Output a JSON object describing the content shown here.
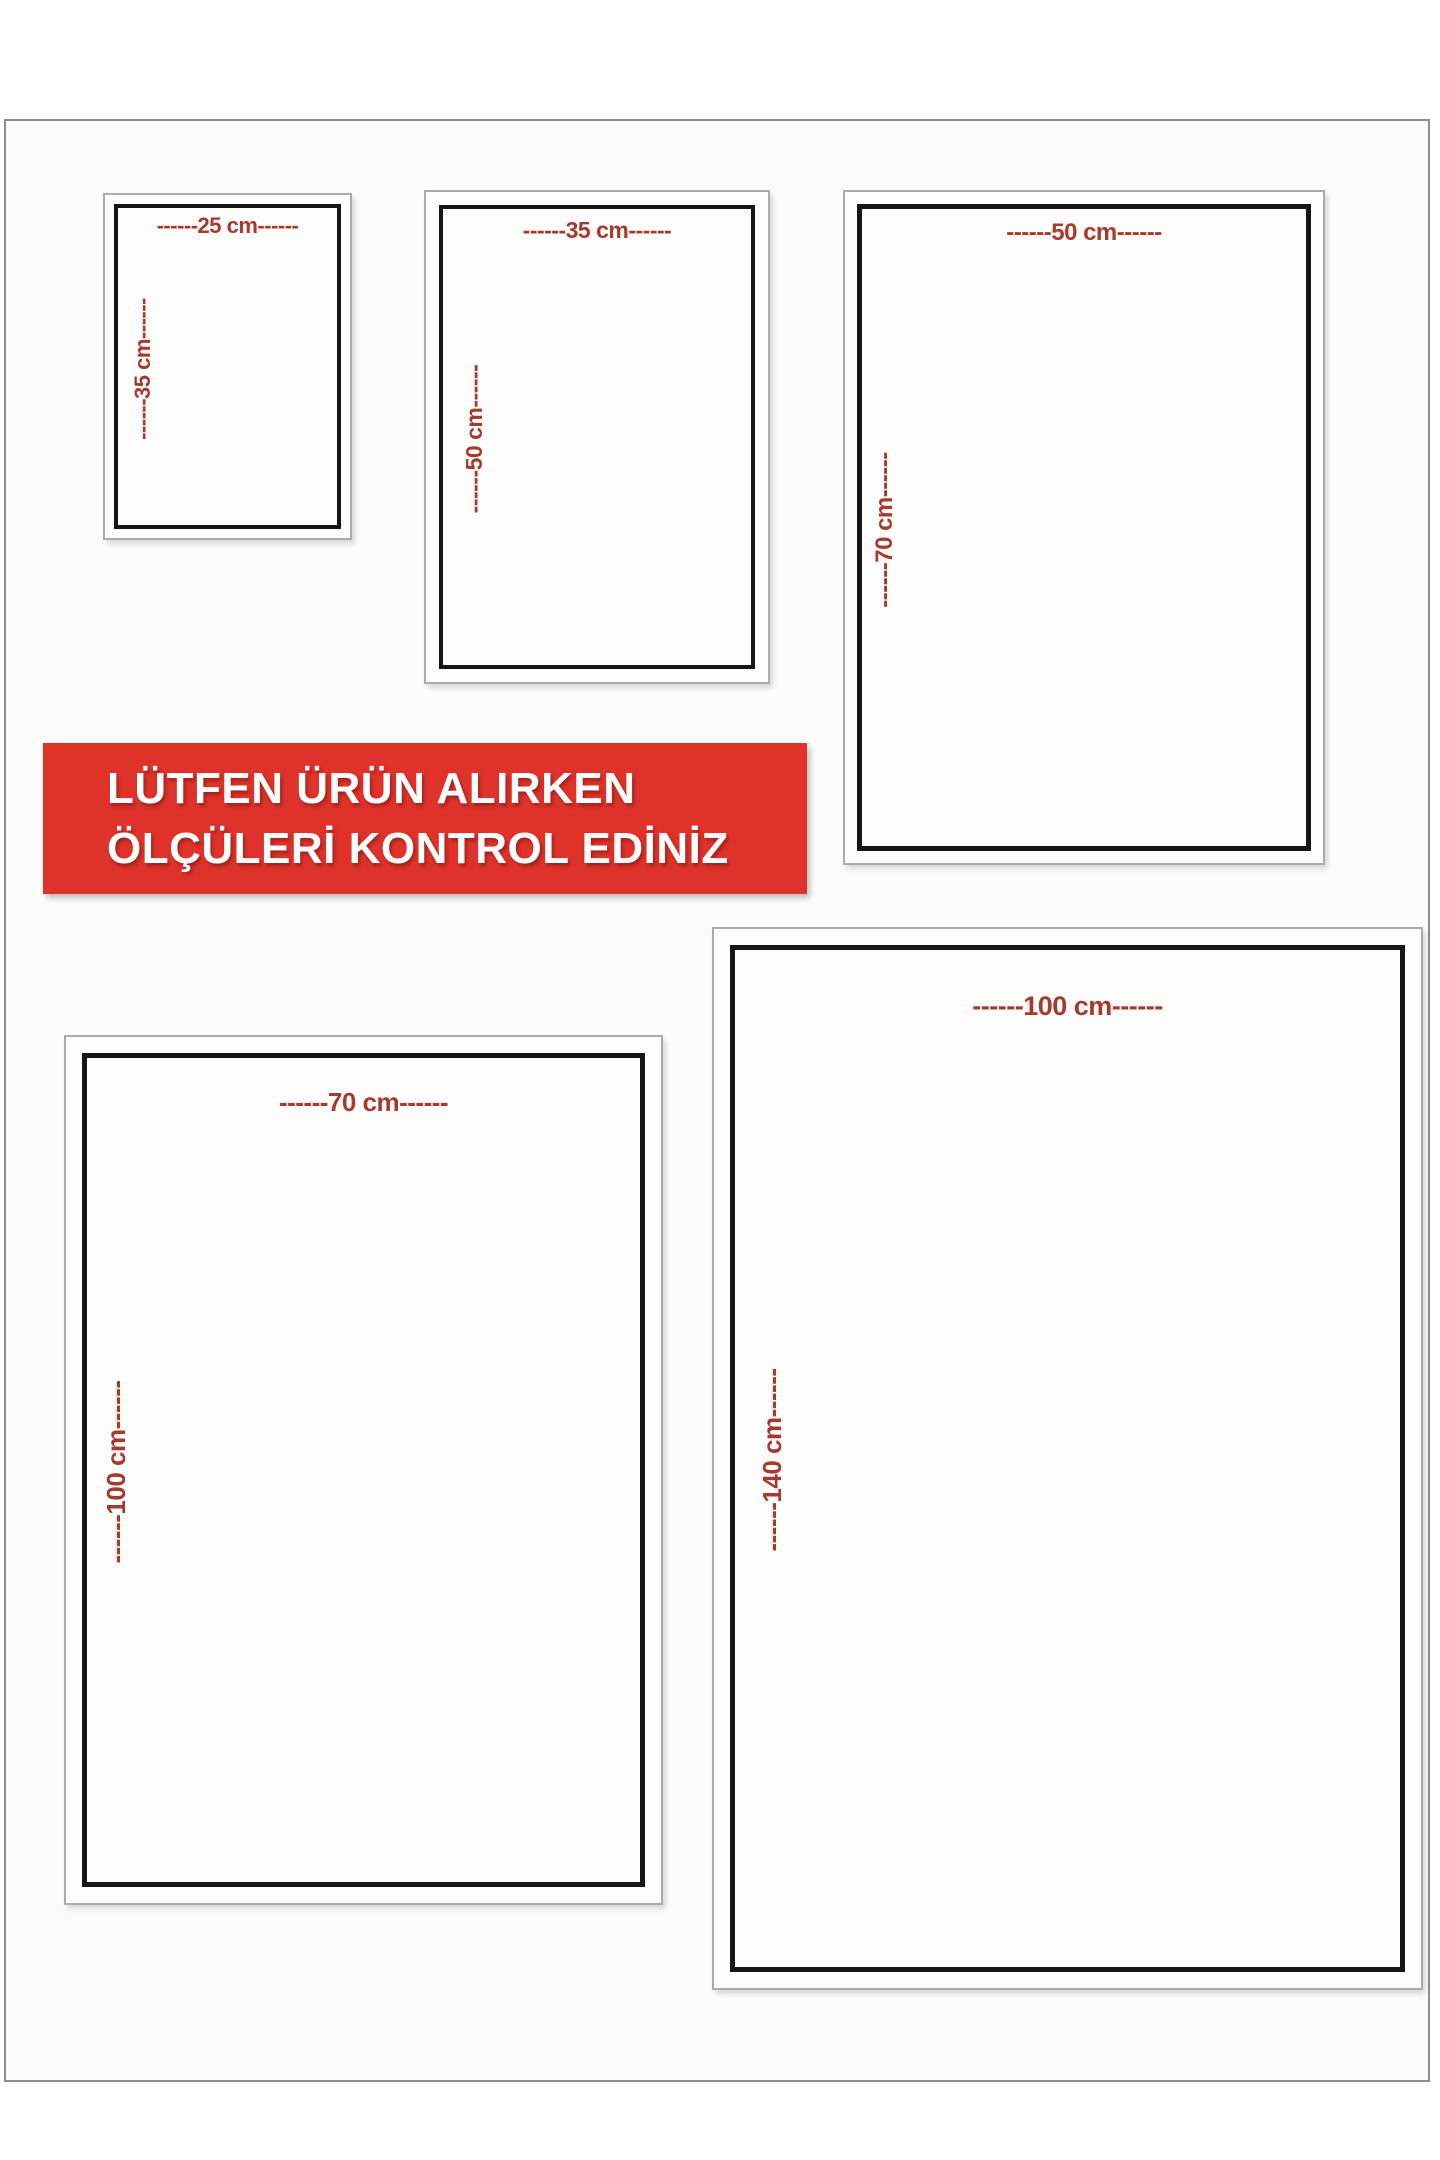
{
  "banner": {
    "line1": "LÜTFEN ÜRÜN ALIRKEN",
    "line2": "ÖLÇÜLERİ KONTROL EDİNİZ",
    "background_color": "#df322a",
    "text_color": "#ffffff"
  },
  "colors": {
    "dimension_label_red": "#a73a2e",
    "inner_frame_black": "#161616",
    "outer_frame_gray": "#ababab",
    "sheet_background": "#fcfcfb"
  },
  "sizes": [
    {
      "name": "25x35 cm",
      "width_cm": 25,
      "height_cm": 35,
      "width_label": "------25 cm------",
      "height_label": "------35 cm------"
    },
    {
      "name": "35x50 cm",
      "width_cm": 35,
      "height_cm": 50,
      "width_label": "------35 cm------",
      "height_label": "------50 cm------"
    },
    {
      "name": "50x70 cm",
      "width_cm": 50,
      "height_cm": 70,
      "width_label": "------50 cm------",
      "height_label": "------70 cm------"
    },
    {
      "name": "70x100 cm",
      "width_cm": 70,
      "height_cm": 100,
      "width_label": "------70 cm------",
      "height_label": "------100 cm------"
    },
    {
      "name": "100x140 cm",
      "width_cm": 100,
      "height_cm": 140,
      "width_label": "------100 cm------",
      "height_label": "------140 cm------"
    }
  ]
}
